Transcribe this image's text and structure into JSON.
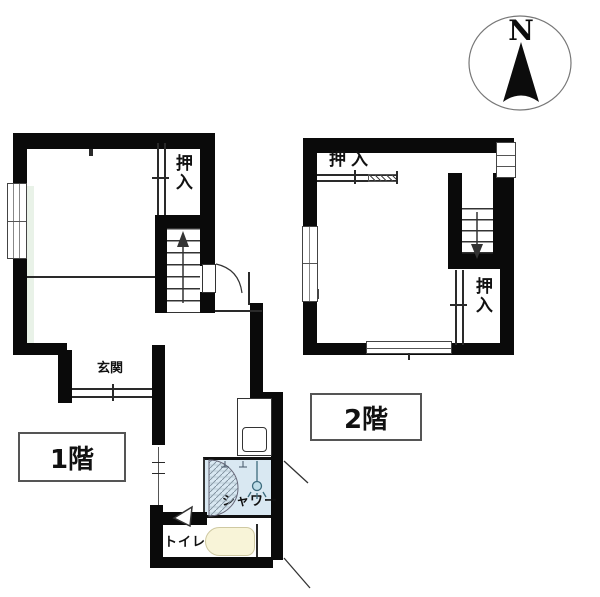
{
  "compass": {
    "label": "N"
  },
  "floor1": {
    "floor_label": "1階",
    "closet_label": "押入",
    "entrance_label": "玄関",
    "shower_label": "シャワー",
    "toilet_label": "トイレ"
  },
  "floor2": {
    "floor_label": "2階",
    "closet_top_label": "押入",
    "closet_bottom_label": "押入"
  },
  "colors": {
    "wall": "#0a0a0a",
    "shower_fill": "#d9e8f2",
    "tub_fill": "#f8f4d8",
    "window_tint": "#e9f2e8"
  }
}
